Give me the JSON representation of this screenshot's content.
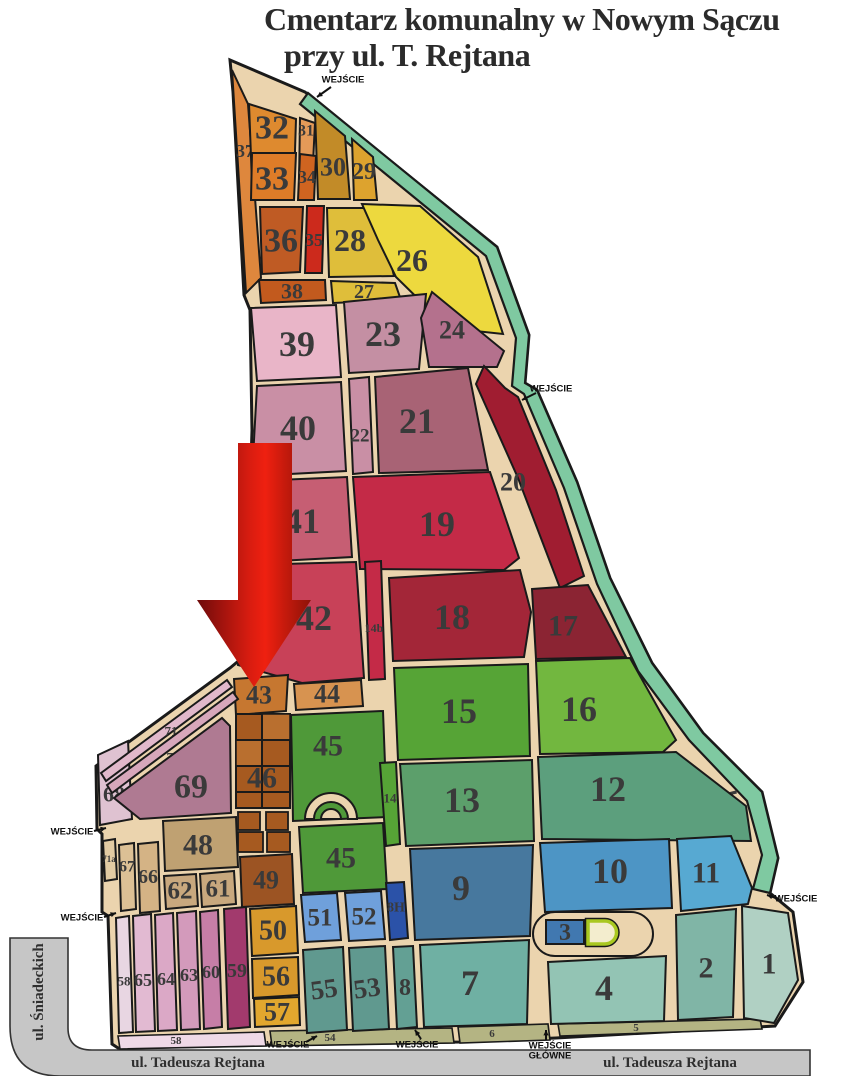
{
  "title": {
    "line1": "Cmentarz komunalny w Nowym Sączu",
    "line2": "przy ul. T. Rejtana"
  },
  "palette": {
    "page_bg": "#ffffff",
    "path_bg": "#EBD4AE",
    "outline": "#1a1a1a",
    "green_strip": "#7FC9A1",
    "road": "#C6C6C6",
    "road_edge": "#333333",
    "label": "#3a3a3a",
    "street_label": "#2f2f2f",
    "entrance_label": "#111111",
    "chapel_fill": "#F3EDCE",
    "chapel_border": "#A9C821",
    "arrow_gradient": [
      "#6E0B0B",
      "#D61C10",
      "#EF2010",
      "#8E1208"
    ]
  },
  "outline": "230,60 305,92 310,96 497,247 529,335 525,383 537,390 577,482 610,578 652,663 703,733 762,792 778,858 770,893 793,912 803,982 775,1026 700,1030 556,1038 460,1042 272,1045 118,1048 112,1044 108,916 102,912 102,834 97,829 96,766 230,668 242,658 248,560 252,430 250,310 244,295 233,92",
  "border": {
    "p": "308,93 497,247 529,335 525,383 537,390 577,482 610,578 652,663 703,733 762,792 778,858 770,893 753,889 762,855 747,801 689,740 638,671 597,584 564,488 524,394 512,386 516,338 486,256 300,104",
    "label": "25",
    "lx": 727,
    "ly": 803,
    "fs": 29,
    "rot": -14
  },
  "roads": {
    "d": "M10,938 L68,938 L68,1028 Q68,1050 92,1050 L810,1050 L810,1076 L60,1076 Q10,1076 10,1026 Z"
  },
  "streets": [
    {
      "t": "ul. Tadeusza Rejtana",
      "x": 198,
      "y": 1063,
      "rot": 0
    },
    {
      "t": "ul. Tadeusza Rejtana",
      "x": 670,
      "y": 1063,
      "rot": 0
    },
    {
      "t": "ul. Śniadeckich",
      "x": 39,
      "y": 992,
      "rot": -90
    }
  ],
  "strips": [
    {
      "p": "118,1036 264,1032 266,1046 120,1049",
      "f": "#EFD9E7",
      "l": "58",
      "x": 176,
      "y": 1041,
      "s": 11
    },
    {
      "p": "270,1031 452,1028 454,1043 272,1046",
      "f": "#B4B483",
      "l": "54",
      "x": 330,
      "y": 1038,
      "s": 11
    },
    {
      "p": "458,1027 548,1024 550,1040 460,1043",
      "f": "#B4B483",
      "l": "6",
      "x": 492,
      "y": 1034,
      "s": 11
    },
    {
      "p": "558,1024 760,1019 762,1029 560,1036",
      "f": "#B4B483",
      "l": "5",
      "x": 636,
      "y": 1028,
      "s": 11
    }
  ],
  "sections": [
    {
      "n": "37",
      "f": "#DE873D",
      "p": "232,70 248,104 261,278 246,293",
      "x": 245,
      "y": 151,
      "s": 18
    },
    {
      "n": "32",
      "f": "#DE8A2F",
      "p": "249,104 296,119 294,183 252,183",
      "x": 272,
      "y": 128,
      "s": 34
    },
    {
      "n": "31",
      "f": "#E49A58",
      "p": "300,118 315,123 312,183 299,183",
      "x": 306,
      "y": 131,
      "s": 16
    },
    {
      "n": "33",
      "f": "#DE7C28",
      "p": "252,153 296,153 294,200 251,200",
      "x": 272,
      "y": 179,
      "s": 34
    },
    {
      "n": "34",
      "f": "#CF6420",
      "p": "300,154 316,156 314,200 298,200",
      "x": 307,
      "y": 177,
      "s": 18
    },
    {
      "n": "36",
      "f": "#BF5B24",
      "p": "260,207 303,207 300,272 262,274",
      "x": 281,
      "y": 241,
      "s": 34
    },
    {
      "n": "35",
      "f": "#CC2A1C",
      "p": "307,206 324,206 322,273 305,273",
      "x": 314,
      "y": 240,
      "s": 18
    },
    {
      "n": "38",
      "f": "#C25A1E",
      "p": "259,280 325,280 326,300 261,303",
      "x": 292,
      "y": 291,
      "s": 22
    },
    {
      "n": "30",
      "f": "#C28B28",
      "p": "315,111 345,136 350,199 318,199",
      "x": 333,
      "y": 167,
      "s": 26
    },
    {
      "n": "29",
      "f": "#DDA32E",
      "p": "352,139 373,157 377,200 354,200",
      "x": 364,
      "y": 172,
      "s": 24
    },
    {
      "n": "28",
      "f": "#DFBE3A",
      "p": "327,208 378,208 394,276 329,277",
      "x": 350,
      "y": 240,
      "s": 32
    },
    {
      "n": "26",
      "f": "#EDD93E",
      "p": "362,204 420,206 478,257 503,334 448,328 396,277 378,240",
      "x": 412,
      "y": 260,
      "s": 32
    },
    {
      "n": "27",
      "f": "#DFBE3A",
      "p": "331,281 395,283 401,300 333,303",
      "x": 364,
      "y": 292,
      "s": 20
    },
    {
      "n": "39",
      "f": "#E9B5C8",
      "p": "251,308 336,305 341,377 257,381",
      "x": 297,
      "y": 344,
      "s": 36
    },
    {
      "n": "23",
      "f": "#C48FA3",
      "p": "344,302 426,294 419,369 349,373",
      "x": 383,
      "y": 334,
      "s": 36
    },
    {
      "n": "24",
      "f": "#B4718D",
      "p": "432,292 504,351 497,367 429,367 421,318",
      "x": 452,
      "y": 330,
      "s": 26
    },
    {
      "n": "40",
      "f": "#C98FA5",
      "p": "257,386 341,382 346,471 252,476",
      "x": 298,
      "y": 428,
      "s": 36
    },
    {
      "n": "22",
      "f": "#C98FA5",
      "p": "349,379 369,377 373,472 353,474",
      "x": 360,
      "y": 436,
      "s": 19
    },
    {
      "n": "21",
      "f": "#A86375",
      "p": "375,377 468,368 488,470 379,473",
      "x": 417,
      "y": 421,
      "s": 36
    },
    {
      "n": "20",
      "f": "#A01D31",
      "p": "484,366 505,388 518,397 556,490 584,576 560,588 518,478 476,384",
      "x": 513,
      "y": 482,
      "s": 26
    },
    {
      "n": "41",
      "f": "#C65E73",
      "p": "254,481 347,477 352,557 260,562",
      "x": 302,
      "y": 521,
      "s": 36
    },
    {
      "n": "19",
      "f": "#C42A47",
      "p": "353,477 490,472 519,558 504,570 360,569",
      "x": 437,
      "y": 524,
      "s": 36
    },
    {
      "n": "42",
      "f": "#C84158",
      "p": "246,565 356,562 364,678 302,683 238,665",
      "x": 314,
      "y": 618,
      "s": 36
    },
    {
      "n": "14b",
      "f": "#C42A47",
      "p": "365,562 381,561 385,679 369,680",
      "x": 374,
      "y": 628,
      "s": 12
    },
    {
      "n": "18",
      "f": "#A32638",
      "p": "389,578 520,570 531,612 524,657 393,661",
      "x": 452,
      "y": 617,
      "s": 36
    },
    {
      "n": "17",
      "f": "#8B2433",
      "p": "532,589 588,585 626,657 536,659",
      "x": 563,
      "y": 626,
      "s": 30
    },
    {
      "n": "43",
      "f": "#C67730",
      "p": "234,679 288,675 286,711 236,715",
      "x": 259,
      "y": 695,
      "s": 26
    },
    {
      "n": "44",
      "f": "#D79350",
      "p": "294,684 361,680 363,706 296,710",
      "x": 327,
      "y": 694,
      "s": 26
    },
    {
      "n": "45",
      "f": "#4F9939",
      "p": "291,715 383,711 387,817 293,821",
      "x": 328,
      "y": 746,
      "s": 30
    },
    {
      "n": "15",
      "f": "#56A436",
      "p": "394,668 528,664 530,756 398,760",
      "x": 459,
      "y": 711,
      "s": 36
    },
    {
      "n": "16",
      "f": "#72B73F",
      "p": "536,661 630,658 676,740 663,752 540,754",
      "x": 579,
      "y": 709,
      "s": 36
    },
    {
      "n": "13",
      "f": "#5C9F6B",
      "p": "400,764 532,760 534,841 406,846",
      "x": 462,
      "y": 800,
      "s": 36
    },
    {
      "n": "12",
      "f": "#5C9F7D",
      "p": "538,757 676,752 746,806 751,841 542,839",
      "x": 608,
      "y": 789,
      "s": 36
    },
    {
      "n": "14",
      "f": "#56A436",
      "p": "380,763 396,762 400,844 386,846",
      "x": 390,
      "y": 798,
      "s": 13
    },
    {
      "n": "45",
      "f": "#4F9939",
      "p": "299,827 383,823 387,889 303,893",
      "x": 341,
      "y": 858,
      "s": 30
    },
    {
      "n": "68",
      "f": "#DFC2D1",
      "p": "98,755 128,741 132,819 100,825",
      "x": 114,
      "y": 794,
      "s": 22
    },
    {
      "n": "71",
      "f": "#E1B8CB",
      "p": "101,773 227,680 232,687 106,781",
      "x": 171,
      "y": 731,
      "s": 13
    },
    {
      "n": "70",
      "f": "#D7A7BB",
      "p": "107,785 233,692 238,699 112,793",
      "x": 173,
      "y": 757,
      "s": 13
    },
    {
      "n": "69",
      "f": "#AF7A92",
      "p": "114,798 222,718 230,726 231,813 140,819",
      "x": 191,
      "y": 787,
      "s": 34
    },
    {
      "n": "48",
      "f": "#BFA172",
      "p": "163,821 236,817 238,867 165,871",
      "x": 198,
      "y": 845,
      "s": 30
    },
    {
      "n": "62",
      "f": "#C8A87E",
      "p": "164,876 196,874 198,906 166,909",
      "x": 180,
      "y": 891,
      "s": 25
    },
    {
      "n": "61",
      "f": "#C8A87E",
      "p": "200,874 234,871 236,904 202,907",
      "x": 218,
      "y": 889,
      "s": 25
    },
    {
      "n": "66",
      "f": "#D4B385",
      "p": "138,844 158,842 160,911 140,913",
      "x": 148,
      "y": 877,
      "s": 20
    },
    {
      "n": "67",
      "f": "#DCC095",
      "p": "119,845 134,843 136,909 121,911",
      "x": 127,
      "y": 867,
      "s": 16
    },
    {
      "n": "71a",
      "f": "#E2CBA3",
      "p": "103,841 115,839 117,879 105,881",
      "x": 109,
      "y": 859,
      "s": 9
    },
    {
      "n": "49",
      "f": "#9C5423",
      "p": "240,857 292,854 294,904 242,907",
      "x": 266,
      "y": 880,
      "s": 26
    },
    {
      "n": "50",
      "f": "#D8992C",
      "p": "250,909 296,906 298,953 252,956",
      "x": 273,
      "y": 931,
      "s": 28
    },
    {
      "n": "56",
      "f": "#D8992C",
      "p": "252,959 298,957 299,995 253,998",
      "x": 276,
      "y": 977,
      "s": 28
    },
    {
      "n": "57",
      "f": "#E2A72E",
      "p": "254,999 299,997 300,1025 255,1027",
      "x": 277,
      "y": 1012,
      "s": 26
    },
    {
      "n": "59",
      "f": "#A23A6D",
      "p": "224,909 246,907 250,1027 228,1029",
      "x": 237,
      "y": 971,
      "s": 20
    },
    {
      "n": "60",
      "f": "#C67EA7",
      "p": "200,912 218,910 222,1027 204,1029",
      "x": 211,
      "y": 972,
      "s": 18
    },
    {
      "n": "63",
      "f": "#D39ABB",
      "p": "177,913 196,911 200,1029 181,1030",
      "x": 189,
      "y": 975,
      "s": 18
    },
    {
      "n": "64",
      "f": "#DBA8C6",
      "p": "155,915 173,913 177,1030 158,1031",
      "x": 166,
      "y": 979,
      "s": 18
    },
    {
      "n": "65",
      "f": "#E2BAD2",
      "p": "133,916 151,914 155,1031 136,1032",
      "x": 143,
      "y": 980,
      "s": 18
    },
    {
      "n": "58",
      "f": "#E8D6E2",
      "p": "116,918 129,916 133,1032 119,1033",
      "x": 124,
      "y": 981,
      "s": 13
    },
    {
      "n": "51",
      "f": "#6FA0DB",
      "p": "301,895 337,893 341,940 305,942",
      "x": 320,
      "y": 918,
      "s": 25
    },
    {
      "n": "52",
      "f": "#6FA0DB",
      "p": "345,893 381,891 385,939 349,941",
      "x": 364,
      "y": 917,
      "s": 25
    },
    {
      "n": "8H",
      "f": "#2B52A8",
      "p": "386,883 404,882 408,938 390,940",
      "x": 396,
      "y": 908,
      "s": 14
    },
    {
      "n": "55",
      "f": "#60998F",
      "p": "303,950 343,947 347,1030 307,1033",
      "x": 324,
      "y": 989,
      "s": 27,
      "r": -8
    },
    {
      "n": "53",
      "f": "#60998F",
      "p": "349,948 385,946 389,1029 353,1031",
      "x": 367,
      "y": 988,
      "s": 27,
      "r": -8
    },
    {
      "n": "8",
      "f": "#63A094",
      "p": "393,947 413,946 417,1027 397,1029",
      "x": 405,
      "y": 988,
      "s": 24
    },
    {
      "n": "7",
      "f": "#6FB0A3",
      "p": "420,945 529,940 527,1024 424,1027",
      "x": 470,
      "y": 983,
      "s": 36
    },
    {
      "n": "9",
      "f": "#47789E",
      "p": "410,849 533,845 530,936 415,940",
      "x": 461,
      "y": 888,
      "s": 36
    },
    {
      "n": "10",
      "f": "#4D95C5",
      "p": "540,843 669,839 672,908 545,912",
      "x": 610,
      "y": 871,
      "s": 36
    },
    {
      "n": "11",
      "f": "#57A9D2",
      "p": "677,839 731,836 752,888 748,904 681,911",
      "x": 706,
      "y": 873,
      "s": 30
    },
    {
      "n": "4",
      "f": "#93C4B4",
      "p": "548,962 666,956 664,1021 551,1024",
      "x": 604,
      "y": 988,
      "s": 36
    },
    {
      "n": "2",
      "f": "#80B5A6",
      "p": "676,915 736,909 733,1017 678,1020",
      "x": 706,
      "y": 968,
      "s": 30
    },
    {
      "n": "1",
      "f": "#B0D0C3",
      "p": "742,906 788,913 798,980 774,1023 744,1018",
      "x": 769,
      "y": 964,
      "s": 30
    }
  ],
  "grid46": {
    "fill": "#A65A20",
    "light": "#B96F2F",
    "x": 236,
    "y": 714,
    "w": 54,
    "h": 94,
    "vx": 262,
    "hy": [
      740,
      766,
      792
    ],
    "light_cells": [
      [
        262,
        714,
        28,
        26
      ],
      [
        236,
        740,
        26,
        26
      ]
    ],
    "cells": [
      [
        238,
        812,
        22,
        18
      ],
      [
        266,
        812,
        22,
        18
      ],
      [
        238,
        832,
        25,
        20
      ],
      [
        267,
        832,
        23,
        20
      ]
    ],
    "label": "46",
    "lx": 262,
    "ly": 778,
    "fs": 30
  },
  "arch": {
    "cx": 331,
    "by": 819,
    "r_outer": 26,
    "r_inner": 17,
    "r_bump": 10
  },
  "extras": {
    "loop": {
      "x": 533,
      "y": 912,
      "w": 120,
      "h": 44,
      "rx": 22
    },
    "sec3": {
      "n": "3",
      "f": "#4178B0",
      "p": "546,920 584,920 584,944 546,944",
      "x": 565,
      "y": 933,
      "s": 24
    },
    "chapel": {
      "d": "M588,921 h17 a11.5,11.5 0 0 1 0,23 h-17 z"
    }
  },
  "arrow": {
    "p": "238,443 292,443 292,600 311,600 254,687 197,600 238,600"
  },
  "entrances": [
    {
      "t": "WEJŚCIE",
      "x": 343,
      "y": 80,
      "a": [
        331,
        87,
        317,
        97
      ]
    },
    {
      "t": "WEJŚCIE",
      "x": 551,
      "y": 389,
      "a": [
        536,
        393,
        522,
        400
      ]
    },
    {
      "t": "WEJŚCIE",
      "x": 72,
      "y": 832,
      "a": [
        94,
        831,
        106,
        828
      ]
    },
    {
      "t": "WEJŚCIE",
      "x": 82,
      "y": 918,
      "a": [
        104,
        917,
        116,
        913
      ]
    },
    {
      "t": "WEJŚCIE",
      "x": 796,
      "y": 899,
      "a": [
        779,
        899,
        767,
        895
      ]
    },
    {
      "t": "WEJŚCIE",
      "x": 288,
      "y": 1045,
      "a": [
        306,
        1042,
        317,
        1036
      ]
    },
    {
      "t": "WEJŚCIE",
      "x": 417,
      "y": 1045,
      "a": [
        421,
        1039,
        415,
        1030
      ]
    },
    {
      "t": "WEJŚCIE",
      "t2": "GŁÓWNE",
      "x": 550,
      "y": 1046,
      "a": [
        546,
        1040,
        546,
        1030
      ]
    }
  ]
}
